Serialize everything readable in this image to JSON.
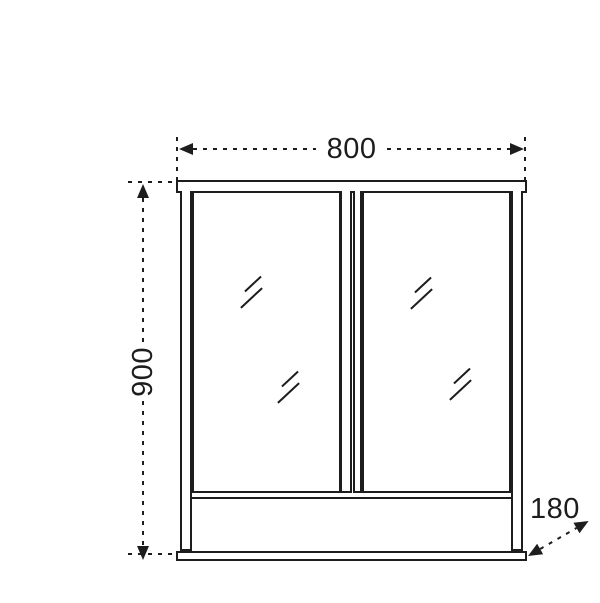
{
  "diagram": {
    "object": "double-door-mirror-cabinet-front-elevation",
    "dimensions": {
      "width": {
        "label": "800"
      },
      "height": {
        "label": "900"
      },
      "depth": {
        "label": "180"
      }
    },
    "style": {
      "line_color": "#1d1d1d",
      "background": "#ffffff"
    }
  }
}
